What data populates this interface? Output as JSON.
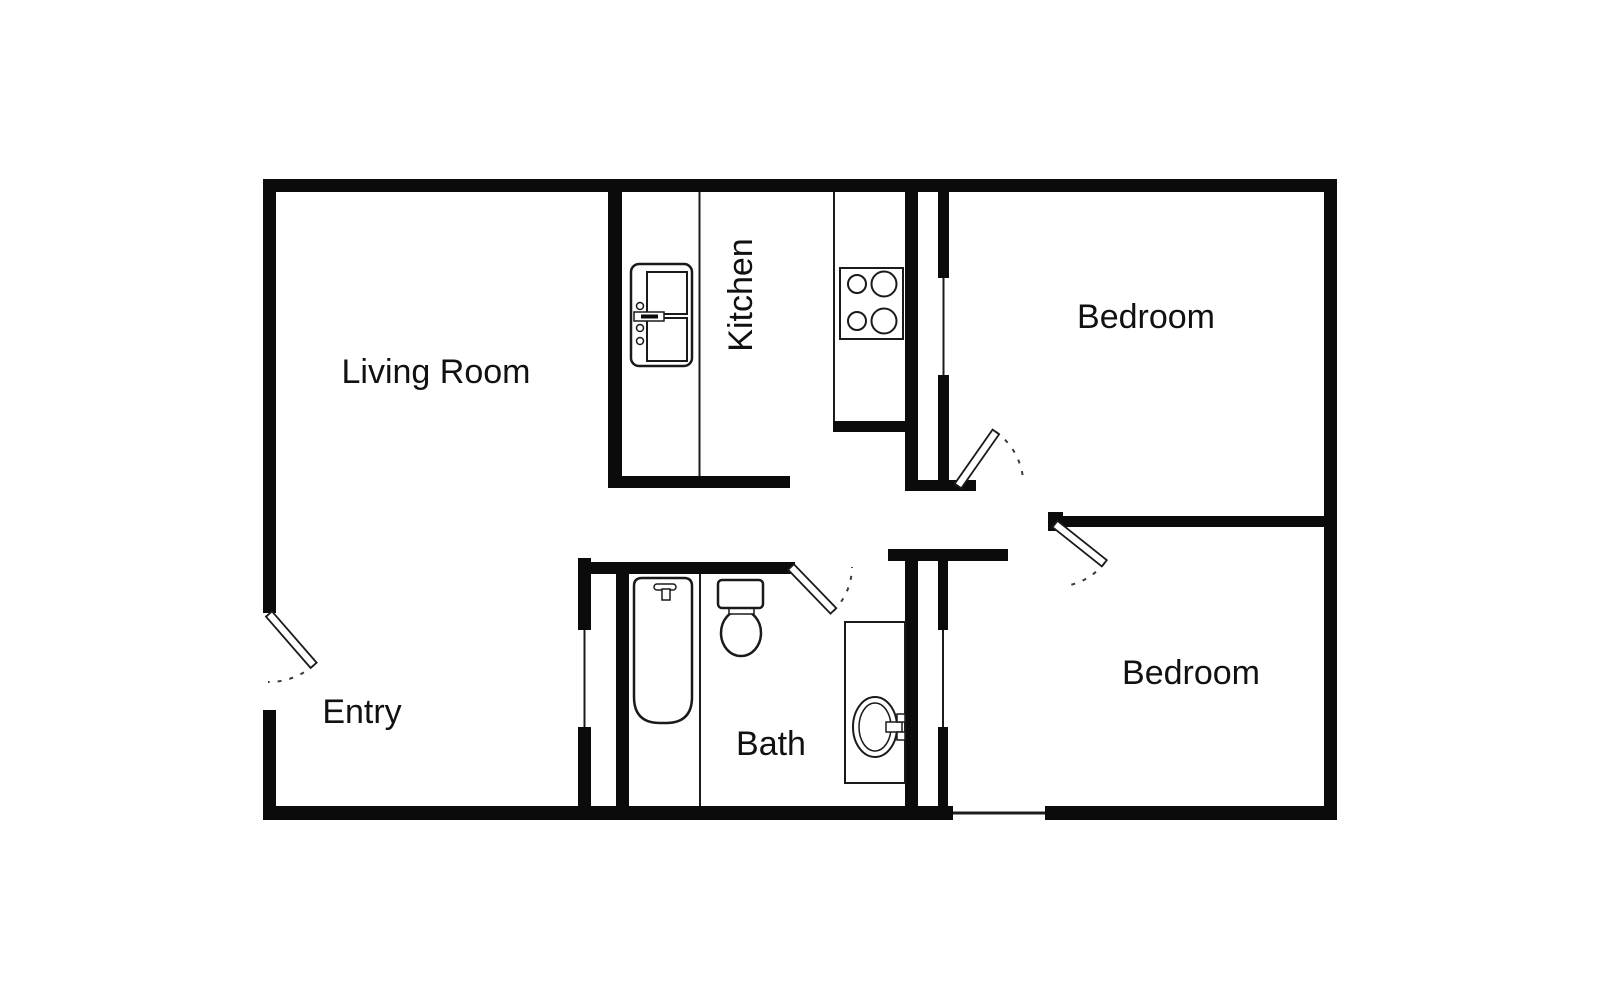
{
  "image": {
    "kind": "floor-plan",
    "width": 1600,
    "height": 1003
  },
  "colors": {
    "background": "#ffffff",
    "wall": "#0b0b0b",
    "thin_line": "#1c1c1c",
    "fixture_line": "#1a1a1a",
    "label": "#111111"
  },
  "labels": {
    "living_room": "Living Room",
    "kitchen": "Kitchen",
    "bedroom_top": "Bedroom",
    "bedroom_bottom": "Bedroom",
    "bath": "Bath",
    "entry": "Entry"
  },
  "fixtures": {
    "oven": "oven-icon",
    "stove": "stove-burners-icon",
    "bathtub": "bathtub-icon",
    "toilet": "toilet-icon",
    "sink": "sink-vanity-icon"
  },
  "doors": {
    "count": 4,
    "style": "swing-arc-dashed"
  }
}
